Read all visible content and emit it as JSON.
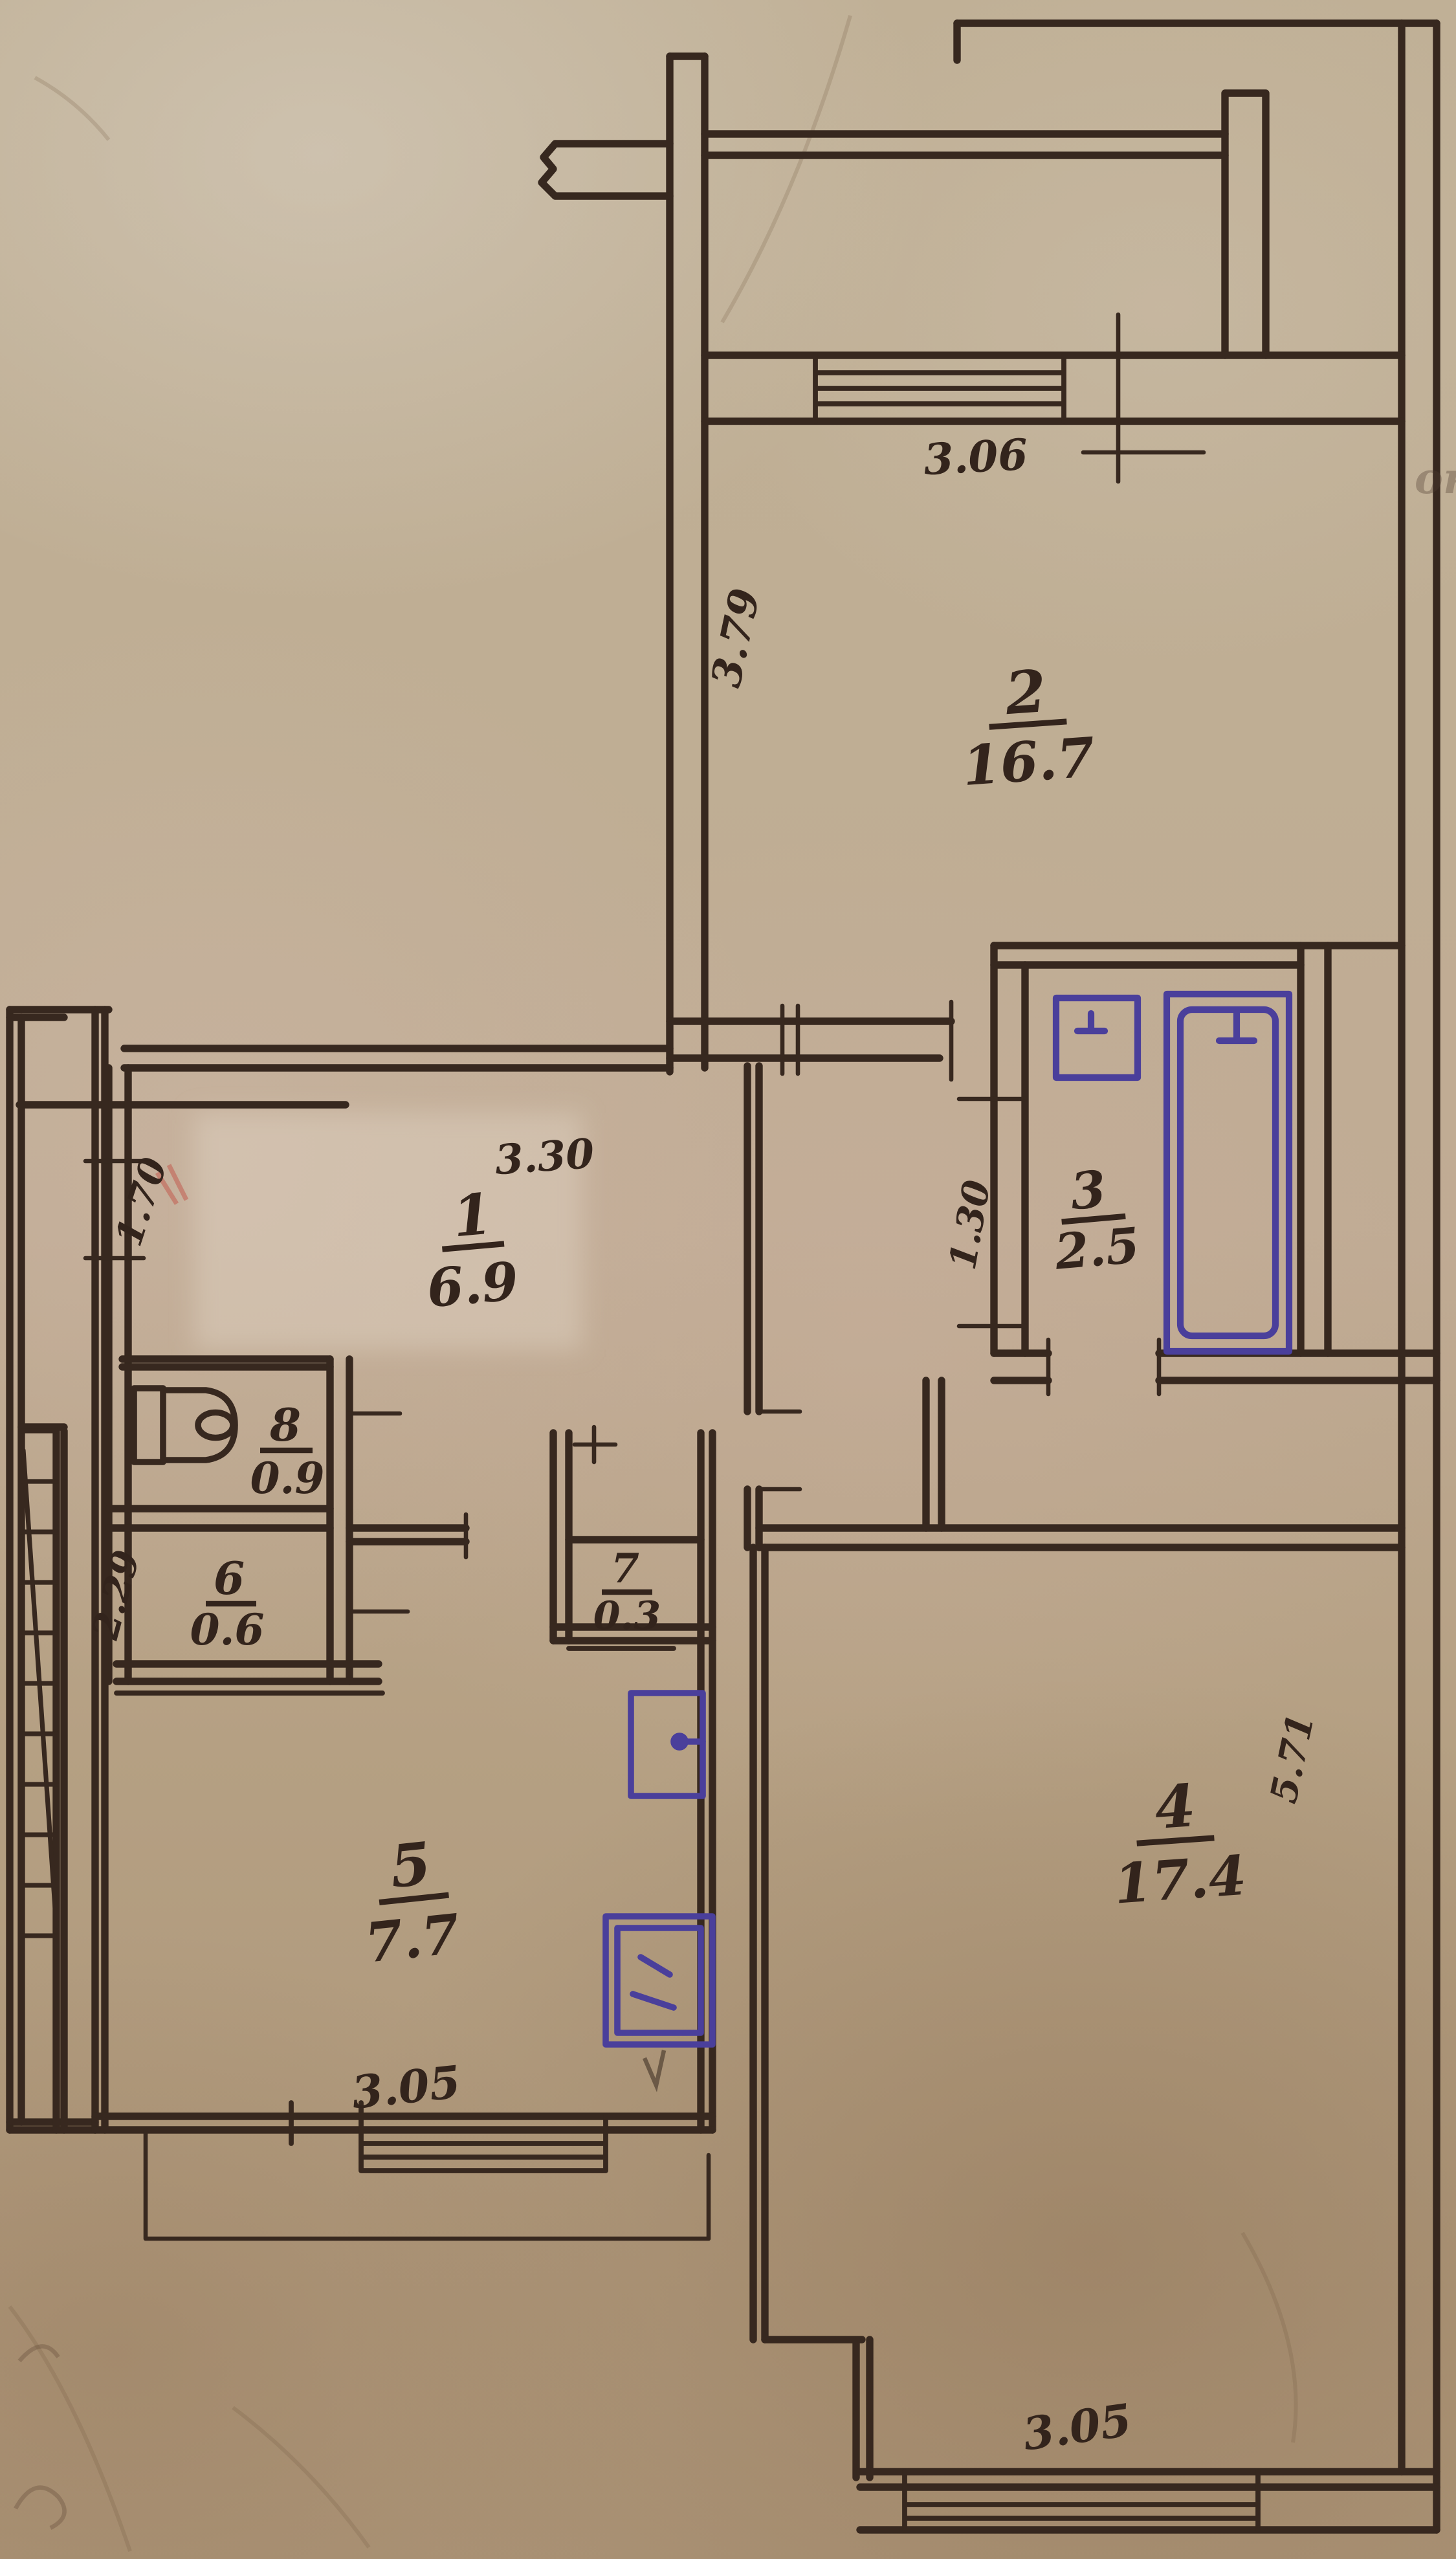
{
  "document": {
    "type": "hand-drawn apartment floor plan scan",
    "units": "meters"
  },
  "colors": {
    "ink": "#37281f",
    "blue_ink": "#4a3f9b",
    "paper": "#b7a48a",
    "red_mark": "#c24a3e"
  },
  "rooms": {
    "r1": {
      "num": "1",
      "area": "6.9"
    },
    "r2": {
      "num": "2",
      "area": "16.7"
    },
    "r3": {
      "num": "3",
      "area": "2.5"
    },
    "r4": {
      "num": "4",
      "area": "17.4"
    },
    "r5": {
      "num": "5",
      "area": "7.7"
    },
    "r6": {
      "num": "6",
      "area": "0.6"
    },
    "r7": {
      "num": "7",
      "area": "0.3"
    },
    "r8": {
      "num": "8",
      "area": "0.9"
    }
  },
  "dims": {
    "room2_top": "3.06",
    "room2_left": "3.79",
    "room1_top": "3.30",
    "room1_left": "1.70",
    "room3_left": "1.30",
    "room4_right": "5.71",
    "room4_bottom": "3.05",
    "room5_left": "2.29",
    "room5_bottom": "3.05"
  },
  "marginalia": {
    "right_edge": "он"
  }
}
